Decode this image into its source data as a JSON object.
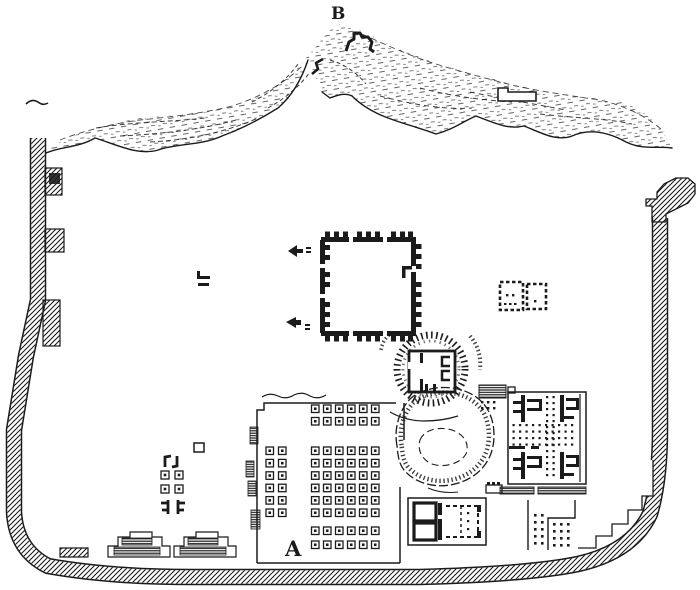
{
  "figure": {
    "labels": {
      "hill": "B",
      "courtyard": "A"
    }
  },
  "colors": {
    "ink": "#1b1b1b",
    "paper": "#ffffff"
  }
}
